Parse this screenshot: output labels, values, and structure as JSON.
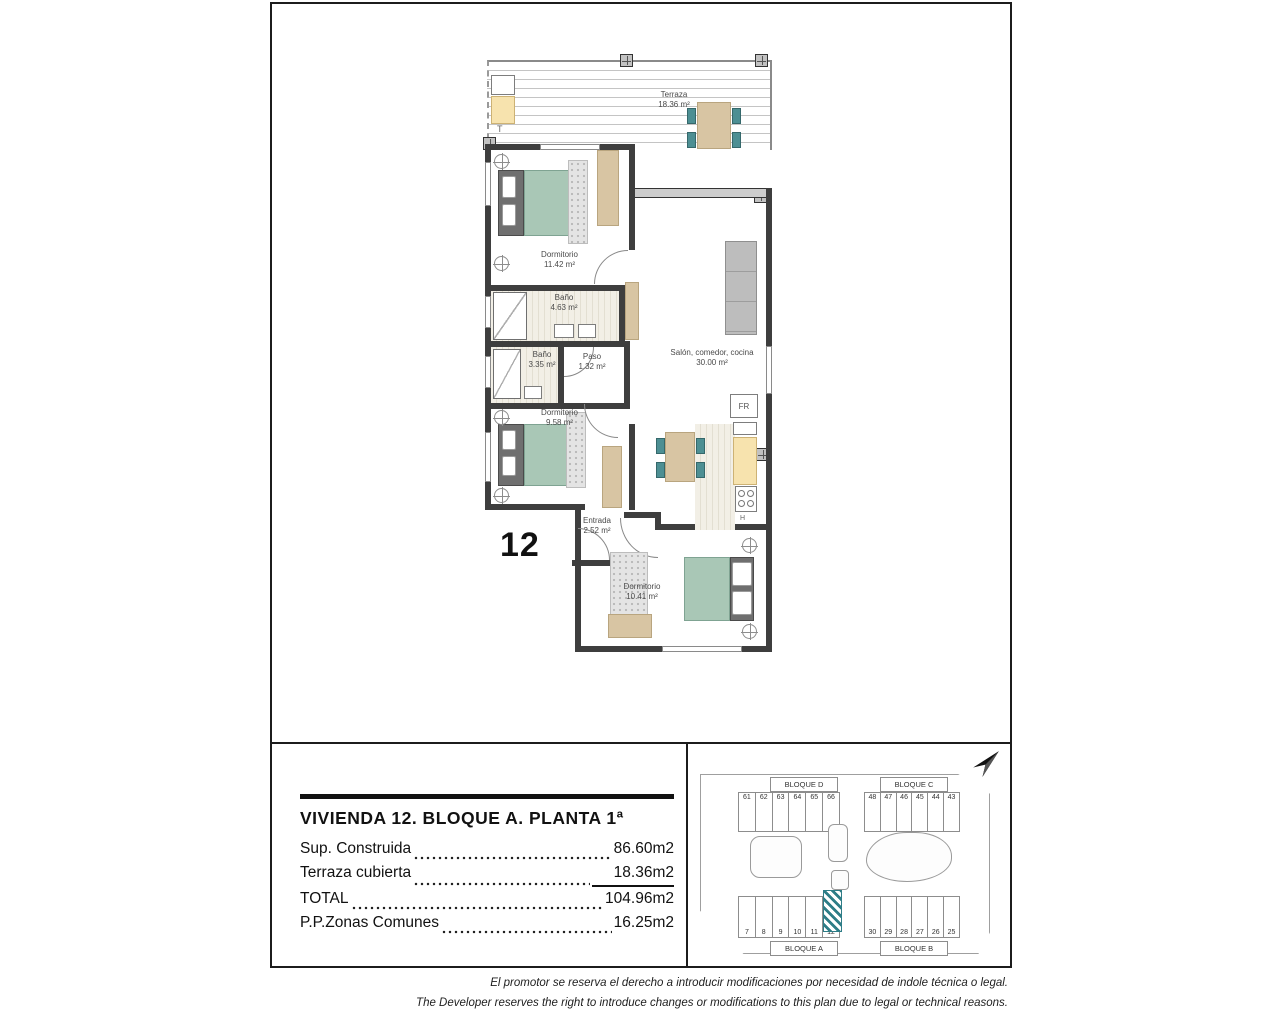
{
  "plan": {
    "unit_label": "12",
    "terrace_marker": "T",
    "fridge_label": "FR",
    "hob_label": "H",
    "rooms": {
      "terraza": {
        "name": "Terraza",
        "area": "18.36 m²"
      },
      "dormitorio_1": {
        "name": "Dormitorio",
        "area": "11.42 m²"
      },
      "bano_1": {
        "name": "Baño",
        "area": "4.63 m²"
      },
      "bano_2": {
        "name": "Baño",
        "area": "3.35 m²"
      },
      "paso": {
        "name": "Paso",
        "area": "1.32 m²"
      },
      "salon": {
        "name": "Salón, comedor, cocina",
        "area": "30.00 m²"
      },
      "dormitorio_2": {
        "name": "Dormitorio",
        "area": "9.58 m²"
      },
      "entrada": {
        "name": "Entrada",
        "area": "2.52 m²"
      },
      "dormitorio_3": {
        "name": "Dormitorio",
        "area": "10.41 m²"
      }
    }
  },
  "summary": {
    "title": "VIVIENDA 12. BLOQUE A. PLANTA 1ª",
    "rows": [
      {
        "label": "Sup. Construida",
        "value": "86.60m2"
      },
      {
        "label": "Terraza cubierta",
        "value": "18.36m2"
      },
      {
        "label": "TOTAL",
        "value": "104.96m2"
      },
      {
        "label": "P.P.Zonas Comunes",
        "value": "16.25m2"
      }
    ]
  },
  "site_plan": {
    "blocks": [
      {
        "name": "BLOQUE D",
        "units": [
          "61",
          "62",
          "63",
          "64",
          "65",
          "66"
        ]
      },
      {
        "name": "BLOQUE C",
        "units": [
          "48",
          "47",
          "46",
          "45",
          "44",
          "43"
        ]
      },
      {
        "name": "BLOQUE A",
        "units": [
          "7",
          "8",
          "9",
          "10",
          "11",
          "12"
        ]
      },
      {
        "name": "BLOQUE B",
        "units": [
          "30",
          "29",
          "28",
          "27",
          "26",
          "25"
        ]
      }
    ],
    "highlighted_unit": "12",
    "highlight_color": "#2e7d87"
  },
  "disclaimer": {
    "es": "El promotor se reserva el derecho a introducir modificaciones por necesidad de indole técnica o legal.",
    "en": "The Developer reserves the right to introduce changes or modifications to this plan due to legal or technical reasons."
  },
  "colors": {
    "bed_teal": "#a9c7b6",
    "furniture_wood": "#d8c5a3",
    "cabinet_yellow": "#f7e3ae",
    "chair_teal": "#4d8f93",
    "sofa_gray": "#bdbdbd",
    "wall_dark": "#3e3e3e"
  }
}
